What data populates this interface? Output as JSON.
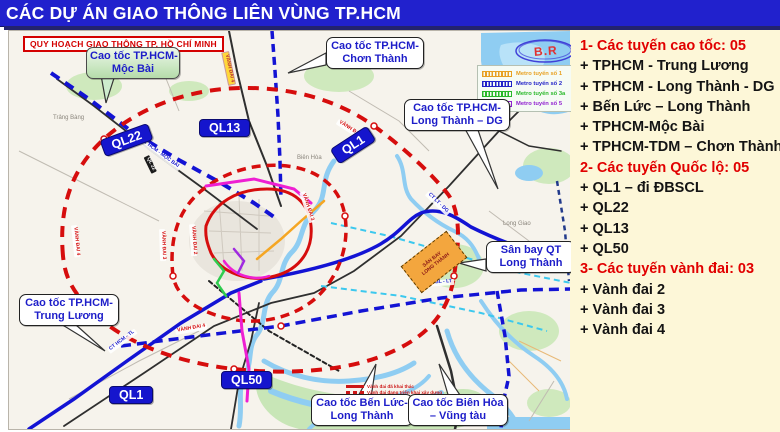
{
  "window": {
    "title": "CÁC DỰ ÁN GIAO THÔNG LIÊN VÙNG TP.HCM"
  },
  "map": {
    "corner_label": "QUY HOẠCH GIAO THÔNG TP. HỒ CHÍ MINH",
    "annotation": "B.R",
    "callouts": {
      "moc_bai": {
        "line1": "Cao tốc TP.HCM-",
        "line2": "Mộc Bài"
      },
      "chon_thanh": {
        "line1": "Cao tốc TP.HCM-",
        "line2": "Chơn Thành"
      },
      "lt_dg": {
        "line1": "Cao tốc TP.HCM-",
        "line2": "Long Thành – DG"
      },
      "san_bay": {
        "line1": "Sân bay QT",
        "line2": "Long Thành"
      },
      "trung_luong": {
        "line1": "Cao tốc TP.HCM-",
        "line2": "Trung Lương"
      },
      "ben_luc": {
        "line1": "Cao tốc Bến Lức-",
        "line2": "Long Thành"
      },
      "bh_vt": {
        "line1": "Cao tốc Biên Hòa",
        "line2": "– Vũng tàu"
      }
    },
    "badges": {
      "ql22": "QL22",
      "ql13": "QL13",
      "ql1_top": "QL1",
      "ql1_bottom": "QL1",
      "ql50": "QL50"
    },
    "metro_legend": [
      {
        "label": "Metro tuyến số 1",
        "color": "#e8a020"
      },
      {
        "label": "Metro tuyến số 2",
        "color": "#2020c8"
      },
      {
        "label": "Metro tuyến số 3a",
        "color": "#28b828"
      },
      {
        "label": "Metro tuyến số 5",
        "color": "#9020d0"
      }
    ],
    "ring_legend": [
      {
        "label": "Vành đai đã khai thác",
        "style": "solid"
      },
      {
        "label": "Vành đai đang triển khai xây dựng",
        "style": "dashed"
      }
    ],
    "route_tags": [
      {
        "text": "CT HCM - MỘC BÀI"
      },
      {
        "text": "CT HCM - TL"
      },
      {
        "text": "CT LT - DG"
      },
      {
        "text": "CT BL - LT"
      },
      {
        "text": "VÀNH ĐAI 3"
      },
      {
        "text": "VÀNH ĐAI 3"
      },
      {
        "text": "VÀNH ĐAI 4"
      },
      {
        "text": "VÀNH ĐAI 4"
      },
      {
        "text": "VÀNH ĐAI 4"
      },
      {
        "text": "VÀNH ĐAI 4"
      },
      {
        "text": "VÀNH ĐAI 2"
      },
      {
        "text": "QL 22"
      }
    ],
    "places": [
      {
        "name": "Trảng Bàng"
      },
      {
        "name": "Biên Hòa"
      },
      {
        "name": "Long Giao"
      }
    ],
    "airport_label": {
      "line1": "SÂN BAY",
      "line2": "LONG THÀNH"
    }
  },
  "sidebar": {
    "sections": [
      {
        "header": "1- Các tuyến cao tốc: 05",
        "items": [
          "+ TPHCM - Trung Lương",
          "+ TPHCM - Long Thành - DG",
          "+ Bến Lức – Long Thành",
          "+ TPHCM-Mộc Bài",
          "+ TPHCM-TDM – Chơn Thành"
        ]
      },
      {
        "header": "2- Các tuyến Quốc lộ: 05",
        "items": [
          "+ QL1 – đi ĐBSCL",
          "+ QL22",
          "+ QL13",
          "+ QL50"
        ]
      },
      {
        "header": "3- Các tuyến vành đai: 03",
        "items": [
          "+ Vành đai 2",
          "+ Vành đai 3",
          "+ Vành đai 4"
        ]
      }
    ]
  },
  "colors": {
    "title_bar_blue": "#2121cd",
    "panel_bg": "#fdf7d8",
    "header_red": "#e10000",
    "badge_blue": "#1515cd",
    "expressway_blue": "#1313d4",
    "ring_red": "#d60d0d",
    "water_blue": "#8fcdf2",
    "airport_orange": "#f3a63e"
  }
}
